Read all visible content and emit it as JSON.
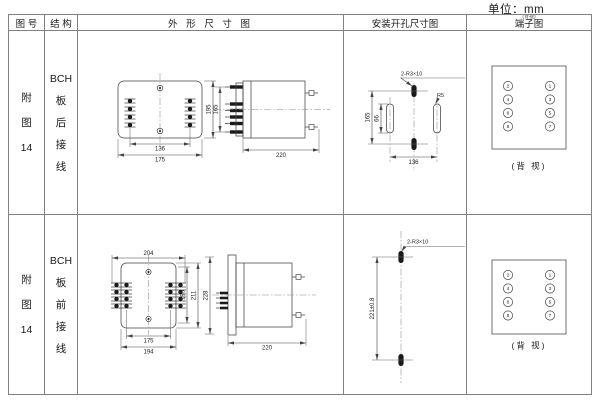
{
  "unit_label": "单位：mm",
  "colors": {
    "line": "#444444",
    "grid": "#808080",
    "text": "#1a1a1a",
    "background": "#ffffff"
  },
  "headers": {
    "figure_no": "图 号",
    "structure": "结 构",
    "outline": "外 形 尺 寸 图",
    "install": "安装开孔尺寸图",
    "terminal": "端子图",
    "terminal_note": "(背视)"
  },
  "rows": [
    {
      "figure_no": [
        "附",
        "图",
        "14"
      ],
      "structure": [
        "BCH",
        "板",
        "后",
        "接",
        "线"
      ],
      "outline": {
        "front": {
          "width_inner": "136",
          "width_outer": "175",
          "height": "195"
        },
        "side": {
          "height": "165",
          "depth": "220"
        }
      },
      "install": {
        "height": "165",
        "slot_len": "66",
        "width": "136",
        "hole_label": "2-R3×10",
        "radius_label": "R5"
      },
      "terminal": {
        "left": [
          "2",
          "4",
          "6",
          "8"
        ],
        "right": [
          "1",
          "3",
          "5",
          "7"
        ],
        "caption": "(背 视)"
      }
    },
    {
      "figure_no": [
        "附",
        "图",
        "14"
      ],
      "structure": [
        "BCH",
        "板",
        "前",
        "接",
        "线"
      ],
      "outline": {
        "front": {
          "width_top": "204",
          "width_inner": "175",
          "width_outer": "194",
          "height_1": "195",
          "height_2": "211",
          "height_3": "228"
        },
        "side": {
          "depth": "220"
        }
      },
      "install": {
        "height": "221±0.8",
        "hole_label": "2-R3×10"
      },
      "terminal": {
        "left": [
          "2",
          "4",
          "6",
          "8"
        ],
        "right": [
          "1",
          "3",
          "5",
          "7"
        ],
        "caption": "(背 视)"
      }
    }
  ]
}
